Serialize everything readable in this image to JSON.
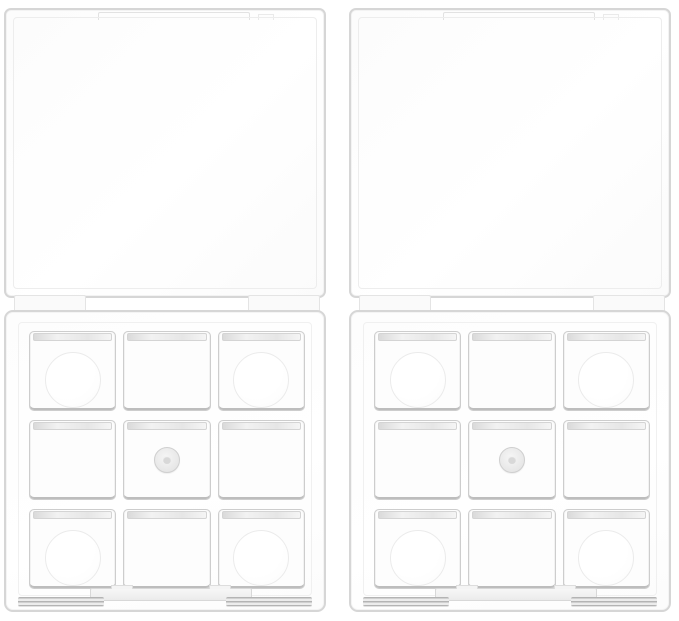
{
  "scene": {
    "type": "product-photo",
    "description": "Two identical empty clear plastic magnetic eyeshadow palette cases shown side by side on a white background, each with its transparent square lid open upward and a base tray holding a 3x3 grid of empty square pan wells",
    "background_color": "#ffffff",
    "item_count": 2
  },
  "palette": {
    "material": "transparent clear plastic",
    "grid": {
      "rows": 3,
      "cols": 3,
      "well_shape": "square"
    },
    "cells": [
      {
        "row": 1,
        "col": 1,
        "feature": "circle"
      },
      {
        "row": 1,
        "col": 2,
        "feature": "plain"
      },
      {
        "row": 1,
        "col": 3,
        "feature": "circle"
      },
      {
        "row": 2,
        "col": 1,
        "feature": "plain"
      },
      {
        "row": 2,
        "col": 2,
        "feature": "magnet"
      },
      {
        "row": 2,
        "col": 3,
        "feature": "plain"
      },
      {
        "row": 3,
        "col": 1,
        "feature": "circle"
      },
      {
        "row": 3,
        "col": 2,
        "feature": "plain"
      },
      {
        "row": 3,
        "col": 3,
        "feature": "circle"
      }
    ],
    "parts": {
      "lid": "open flat transparent lid with top edge tab",
      "hinge": "two striped hinge bars joined by a dark junction line",
      "base": "square tray with nine recessed square wells",
      "magnet": "small round magnet stud in center well",
      "latch": "front center latch bar with grooved strips at both bottom corners"
    }
  },
  "palettes": [
    {
      "position": "left"
    },
    {
      "position": "right"
    }
  ],
  "colors": {
    "bg": "#ffffff",
    "shell": "#d6d6d6",
    "shelllight": "#ececec",
    "fill": "#fdfdfd",
    "line": "#8d8d8d",
    "stripe": "#a8a8a8",
    "cellborder": "#cdcdcd",
    "lip1": "#e0e0e0",
    "lip2": "#f8f8f8",
    "cellshadow": "#bdbdbd",
    "impression": "#ebebeb",
    "magnet1": "#f6f6f6",
    "magnet2": "#e0e0e0"
  }
}
